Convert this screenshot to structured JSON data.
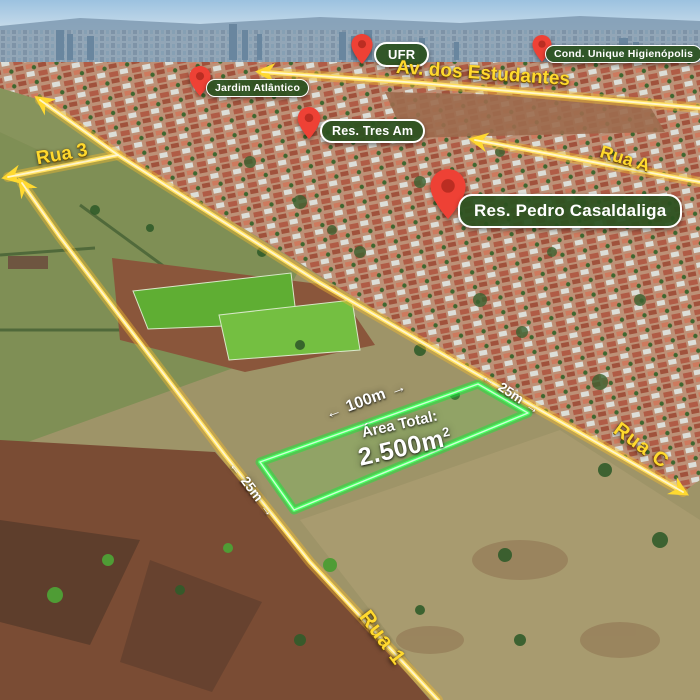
{
  "pins": [
    {
      "id": "ufr",
      "label": "UFR"
    },
    {
      "id": "cond-unique-higienopolis",
      "label": "Cond. Unique Higienópolis"
    },
    {
      "id": "jardim-atlantico",
      "label": "Jardim Atlântico"
    },
    {
      "id": "res-tres-am",
      "label": "Res. Tres Am"
    },
    {
      "id": "res-pedro-casaldaliga",
      "label": "Res. Pedro Casaldaliga"
    }
  ],
  "roads": {
    "av_estudantes": "Av. dos Estudantes",
    "rua_a": "Rua A",
    "rua_3": "Rua 3",
    "rua_c": "Rua C",
    "rua_1": "Rua 1"
  },
  "lot": {
    "area_label": "Área Total:",
    "area_value": "2.500m",
    "area_exponent": "2",
    "front_length": "100m",
    "side_length_right": "25m",
    "side_length_left": "25m"
  },
  "icons": {
    "arrow_left": "←",
    "arrow_right": "→",
    "map_pin": "map-pin"
  },
  "colors": {
    "road_yellow": "#ffdf5e",
    "road_label_yellow": "#ffd92e",
    "lot_green": "#49ff63",
    "pin_red": "#ee4135",
    "pill_green": "#2c5220",
    "sky_blue": "#a9cbe4"
  }
}
